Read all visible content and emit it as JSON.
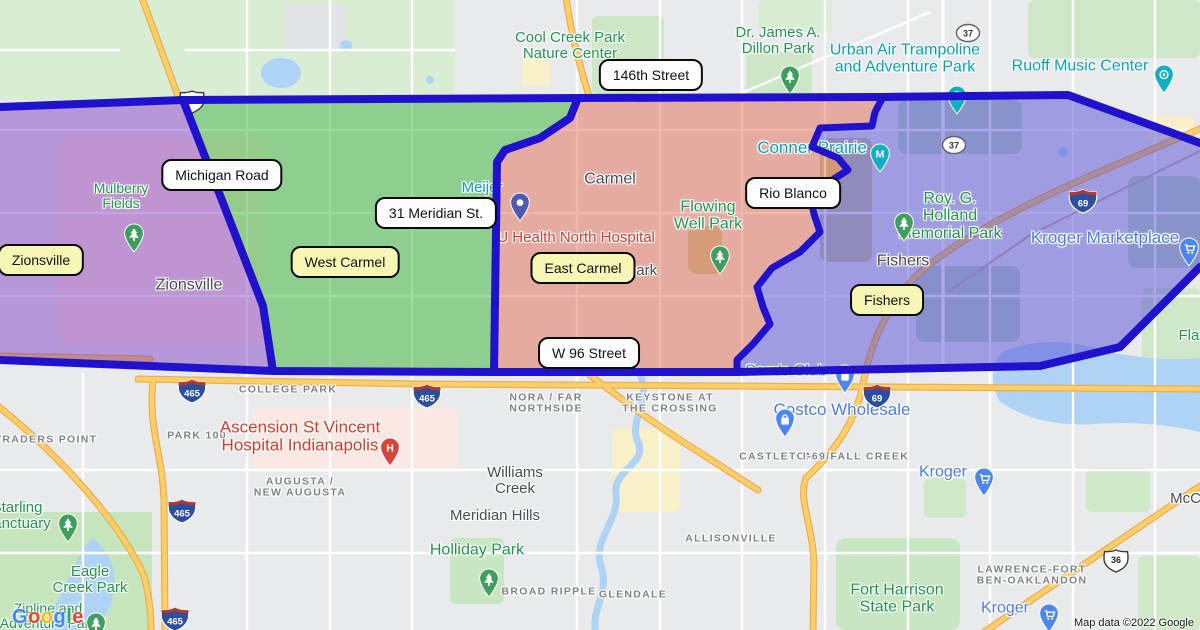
{
  "attribution": "Map data ©2022 Google",
  "google_logo": {
    "letters": [
      {
        "ch": "G",
        "color": "#4285F4"
      },
      {
        "ch": "o",
        "color": "#EA4335"
      },
      {
        "ch": "o",
        "color": "#FBBC05"
      },
      {
        "ch": "g",
        "color": "#4285F4"
      },
      {
        "ch": "l",
        "color": "#34A853"
      },
      {
        "ch": "e",
        "color": "#EA4335"
      }
    ]
  },
  "regions": {
    "border_color": "#2012cc",
    "purple": {
      "territory": "Zionsville",
      "fill": "rgba(128,62,196,0.48)"
    },
    "green": {
      "territory": "West Carmel",
      "fill": "rgba(44,178,44,0.48)"
    },
    "red": {
      "territory": "East Carmel",
      "fill": "rgba(224,84,58,0.42)"
    },
    "blue": {
      "territory": "Fishers",
      "fill": "rgba(82,72,214,0.48)"
    }
  },
  "callouts": [
    {
      "style": "white",
      "text": "146th Street",
      "x": 651,
      "y": 75
    },
    {
      "style": "white",
      "text": "Michigan Road",
      "x": 222,
      "y": 175
    },
    {
      "style": "white",
      "text": "31 Meridian St.",
      "x": 436,
      "y": 213
    },
    {
      "style": "white",
      "text": "Rio Blanco",
      "x": 793,
      "y": 193
    },
    {
      "style": "white",
      "text": "W 96 Street",
      "x": 589,
      "y": 353
    },
    {
      "style": "yellow",
      "text": "Zionsville",
      "x": 41,
      "y": 260
    },
    {
      "style": "yellow",
      "text": "West Carmel",
      "x": 345,
      "y": 262
    },
    {
      "style": "yellow",
      "text": "East Carmel",
      "x": 583,
      "y": 268
    },
    {
      "style": "yellow",
      "text": "Fishers",
      "x": 887,
      "y": 300
    }
  ],
  "labels": [
    {
      "type": "city",
      "lines": [
        "Zionsville"
      ],
      "x": 189,
      "y": 285,
      "size": 16,
      "name": "zionsville-city-label"
    },
    {
      "type": "city",
      "lines": [
        "Carmel"
      ],
      "x": 610,
      "y": 179,
      "size": 16,
      "name": "carmel-city-label"
    },
    {
      "type": "city",
      "lines": [
        "Fishers"
      ],
      "x": 903,
      "y": 261,
      "size": 16,
      "name": "fishers-city-label"
    },
    {
      "type": "city",
      "lines": [
        "Williams",
        "Creek"
      ],
      "x": 515,
      "y": 481,
      "size": 15,
      "name": "williams-creek-label"
    },
    {
      "type": "city",
      "lines": [
        "Meridian Hills"
      ],
      "x": 495,
      "y": 516,
      "size": 15,
      "name": "meridian-hills-label"
    },
    {
      "type": "city",
      "lines": [
        "rpark"
      ],
      "x": 640,
      "y": 271,
      "size": 15,
      "name": "partial-label-rpark"
    },
    {
      "type": "city",
      "lines": [
        "McCordsville"
      ],
      "x": 1213,
      "y": 499,
      "size": 15,
      "name": "mccordsville-label"
    },
    {
      "type": "area",
      "lines": [
        "TRADERS POINT"
      ],
      "x": 46,
      "y": 440,
      "name": "traders-point-label"
    },
    {
      "type": "area",
      "lines": [
        "PARK 100"
      ],
      "x": 197,
      "y": 436,
      "name": "park-100-label"
    },
    {
      "type": "area",
      "lines": [
        "COLLEGE PARK"
      ],
      "x": 288,
      "y": 390,
      "name": "college-park-label"
    },
    {
      "type": "area",
      "lines": [
        "AUGUSTA /",
        "NEW AUGUSTA"
      ],
      "x": 300,
      "y": 488,
      "name": "augusta-label"
    },
    {
      "type": "area",
      "lines": [
        "NORA / FAR",
        "NORTHSIDE"
      ],
      "x": 546,
      "y": 404,
      "name": "nora-far-northside-label"
    },
    {
      "type": "area",
      "lines": [
        "KEYSTONE AT",
        "THE CROSSING"
      ],
      "x": 670,
      "y": 404,
      "name": "keystone-crossing-label"
    },
    {
      "type": "area",
      "lines": [
        "BROAD RIPPLE"
      ],
      "x": 549,
      "y": 592,
      "name": "broad-ripple-label"
    },
    {
      "type": "area",
      "lines": [
        "GLENDALE"
      ],
      "x": 633,
      "y": 595,
      "name": "glendale-label"
    },
    {
      "type": "area",
      "lines": [
        "ALLISONVILLE"
      ],
      "x": 731,
      "y": 539,
      "name": "allisonville-label"
    },
    {
      "type": "area",
      "lines": [
        "CASTLETON"
      ],
      "x": 777,
      "y": 457,
      "name": "castleton-label"
    },
    {
      "type": "area",
      "lines": [
        "I-69/FALL CREEK"
      ],
      "x": 856,
      "y": 457,
      "name": "i69-fall-creek-label"
    },
    {
      "type": "area",
      "lines": [
        "LAWRENCE-FORT",
        "BEN-OAKLANDON"
      ],
      "x": 1032,
      "y": 576,
      "name": "lawrence-fort-ben-label"
    },
    {
      "type": "park",
      "lines": [
        "Mulberry",
        "Fields"
      ],
      "x": 121,
      "y": 196,
      "size": 14,
      "name": "mulberry-fields-label"
    },
    {
      "type": "park",
      "lines": [
        "Cool Creek Park",
        "Nature Center"
      ],
      "x": 570,
      "y": 46,
      "size": 15,
      "name": "cool-creek-park-label"
    },
    {
      "type": "park",
      "lines": [
        "Dr. James A.",
        "Dillon Park"
      ],
      "x": 778,
      "y": 41,
      "size": 15,
      "name": "dillon-park-label"
    },
    {
      "type": "park",
      "lines": [
        "Flowing",
        "Well Park"
      ],
      "x": 708,
      "y": 216,
      "size": 16,
      "name": "flowing-well-park-label"
    },
    {
      "type": "park",
      "lines": [
        "Roy. G.",
        "Holland",
        "Memorial Park"
      ],
      "x": 950,
      "y": 216,
      "size": 16,
      "name": "holland-memorial-park-label"
    },
    {
      "type": "park",
      "lines": [
        "Holliday Park"
      ],
      "x": 477,
      "y": 550,
      "size": 16,
      "name": "holliday-park-label"
    },
    {
      "type": "park",
      "lines": [
        "Starling",
        "Sanctuary"
      ],
      "x": 17,
      "y": 516,
      "size": 15,
      "name": "starling-sanctuary-label"
    },
    {
      "type": "park",
      "lines": [
        "Eagle",
        "Creek Park"
      ],
      "x": 90,
      "y": 580,
      "size": 15,
      "name": "eagle-creek-park-label"
    },
    {
      "type": "park",
      "lines": [
        "Zipline and",
        "Adventure Park"
      ],
      "x": 48,
      "y": 616,
      "size": 14,
      "name": "zipline-adventure-park-label"
    },
    {
      "type": "park",
      "lines": [
        "Fort Harrison",
        "State Park"
      ],
      "x": 897,
      "y": 599,
      "size": 16,
      "name": "fort-harrison-label"
    },
    {
      "type": "park",
      "lines": [
        "Flat"
      ],
      "x": 1191,
      "y": 336,
      "size": 15,
      "name": "flat-fork-label"
    },
    {
      "type": "poi",
      "lines": [
        "Urban Air Trampoline",
        "and Adventure Park"
      ],
      "x": 905,
      "y": 59,
      "size": 16,
      "name": "urban-air-label"
    },
    {
      "type": "poi",
      "lines": [
        "Ruoff Music Center"
      ],
      "x": 1080,
      "y": 66,
      "size": 16,
      "name": "ruoff-music-center-label"
    },
    {
      "type": "poi",
      "lines": [
        "Conner Prairie"
      ],
      "x": 812,
      "y": 148,
      "size": 17,
      "name": "conner-prairie-label"
    },
    {
      "type": "poi",
      "lines": [
        "Meijer"
      ],
      "x": 482,
      "y": 188,
      "size": 15,
      "name": "meijer-label"
    },
    {
      "type": "store",
      "lines": [
        "Kroger Marketplace"
      ],
      "x": 1105,
      "y": 238,
      "size": 17,
      "name": "kroger-marketplace-label"
    },
    {
      "type": "store",
      "lines": [
        "Costco Wholesale"
      ],
      "x": 842,
      "y": 410,
      "size": 17,
      "name": "costco-label"
    },
    {
      "type": "store",
      "lines": [
        "Kroger"
      ],
      "x": 943,
      "y": 472,
      "size": 16,
      "name": "kroger-label"
    },
    {
      "type": "store",
      "lines": [
        "Kroger"
      ],
      "x": 1005,
      "y": 608,
      "size": 16,
      "name": "kroger-south-label"
    },
    {
      "type": "store",
      "lines": [
        "Sam's Club"
      ],
      "x": 786,
      "y": 371,
      "size": 16,
      "name": "sams-club-label"
    },
    {
      "type": "hospital",
      "lines": [
        "IU Health North Hospital"
      ],
      "x": 574,
      "y": 238,
      "size": 15,
      "name": "iu-health-label"
    },
    {
      "type": "hospital",
      "lines": [
        "Ascension St Vincent",
        "Hospital Indianapolis"
      ],
      "x": 300,
      "y": 437,
      "size": 17,
      "name": "ascension-hospital-label"
    }
  ],
  "pins": [
    {
      "glyph": "tree",
      "color": "#3f9d5d",
      "x": 122,
      "y": 223,
      "name": "mulberry-fields-pin"
    },
    {
      "glyph": "tree",
      "color": "#3f9d5d",
      "x": 778,
      "y": 65,
      "name": "dillon-park-pin"
    },
    {
      "glyph": "tree",
      "color": "#3f9d5d",
      "x": 708,
      "y": 245,
      "name": "flowing-well-park-pin"
    },
    {
      "glyph": "tree",
      "color": "#3f9d5d",
      "x": 892,
      "y": 212,
      "name": "holland-memorial-park-pin"
    },
    {
      "glyph": "tree",
      "color": "#3f9d5d",
      "x": 477,
      "y": 568,
      "name": "holliday-park-pin"
    },
    {
      "glyph": "tree",
      "color": "#3f9d5d",
      "x": 56,
      "y": 513,
      "name": "starling-sanctuary-pin"
    },
    {
      "glyph": "tree",
      "color": "#3f9d5d",
      "x": 84,
      "y": 612,
      "name": "zipline-park-pin"
    },
    {
      "glyph": "spark",
      "color": "#14aec2",
      "x": 945,
      "y": 85,
      "name": "urban-air-pin"
    },
    {
      "glyph": "spark",
      "color": "#14aec2",
      "x": 1152,
      "y": 64,
      "name": "ruoff-music-center-pin"
    },
    {
      "glyph": "M",
      "color": "#14aec2",
      "x": 868,
      "y": 143,
      "name": "conner-prairie-pin"
    },
    {
      "glyph": "cart",
      "color": "#4d86f0",
      "x": 1177,
      "y": 237,
      "name": "kroger-marketplace-pin"
    },
    {
      "glyph": "bag",
      "color": "#4d86f0",
      "x": 773,
      "y": 408,
      "name": "costco-pin"
    },
    {
      "glyph": "cart",
      "color": "#4d86f0",
      "x": 972,
      "y": 467,
      "name": "kroger-pin"
    },
    {
      "glyph": "cart",
      "color": "#4d86f0",
      "x": 1037,
      "y": 603,
      "name": "kroger-south-pin"
    },
    {
      "glyph": "bag",
      "color": "#4d86f0",
      "x": 833,
      "y": 364,
      "name": "sams-club-pin"
    },
    {
      "glyph": "H",
      "color": "#d6453c",
      "x": 378,
      "y": 437,
      "name": "ascension-hospital-pin"
    },
    {
      "glyph": "dot",
      "color": "#4f5bb0",
      "x": 508,
      "y": 192,
      "name": "meijer-pin"
    }
  ],
  "shields": [
    {
      "kind": "us",
      "num": "421",
      "x": 178,
      "y": 89
    },
    {
      "kind": "state",
      "num": "37",
      "x": 955,
      "y": 23
    },
    {
      "kind": "state",
      "num": "37",
      "x": 941,
      "y": 135
    },
    {
      "kind": "interstate",
      "num": "465",
      "x": 177,
      "y": 378
    },
    {
      "kind": "interstate",
      "num": "465",
      "x": 412,
      "y": 383
    },
    {
      "kind": "interstate",
      "num": "465",
      "x": 167,
      "y": 498
    },
    {
      "kind": "interstate",
      "num": "465",
      "x": 160,
      "y": 606
    },
    {
      "kind": "interstate",
      "num": "69",
      "x": 1068,
      "y": 188
    },
    {
      "kind": "interstate",
      "num": "69",
      "x": 862,
      "y": 383
    },
    {
      "kind": "us",
      "num": "36",
      "x": 1102,
      "y": 548
    }
  ]
}
